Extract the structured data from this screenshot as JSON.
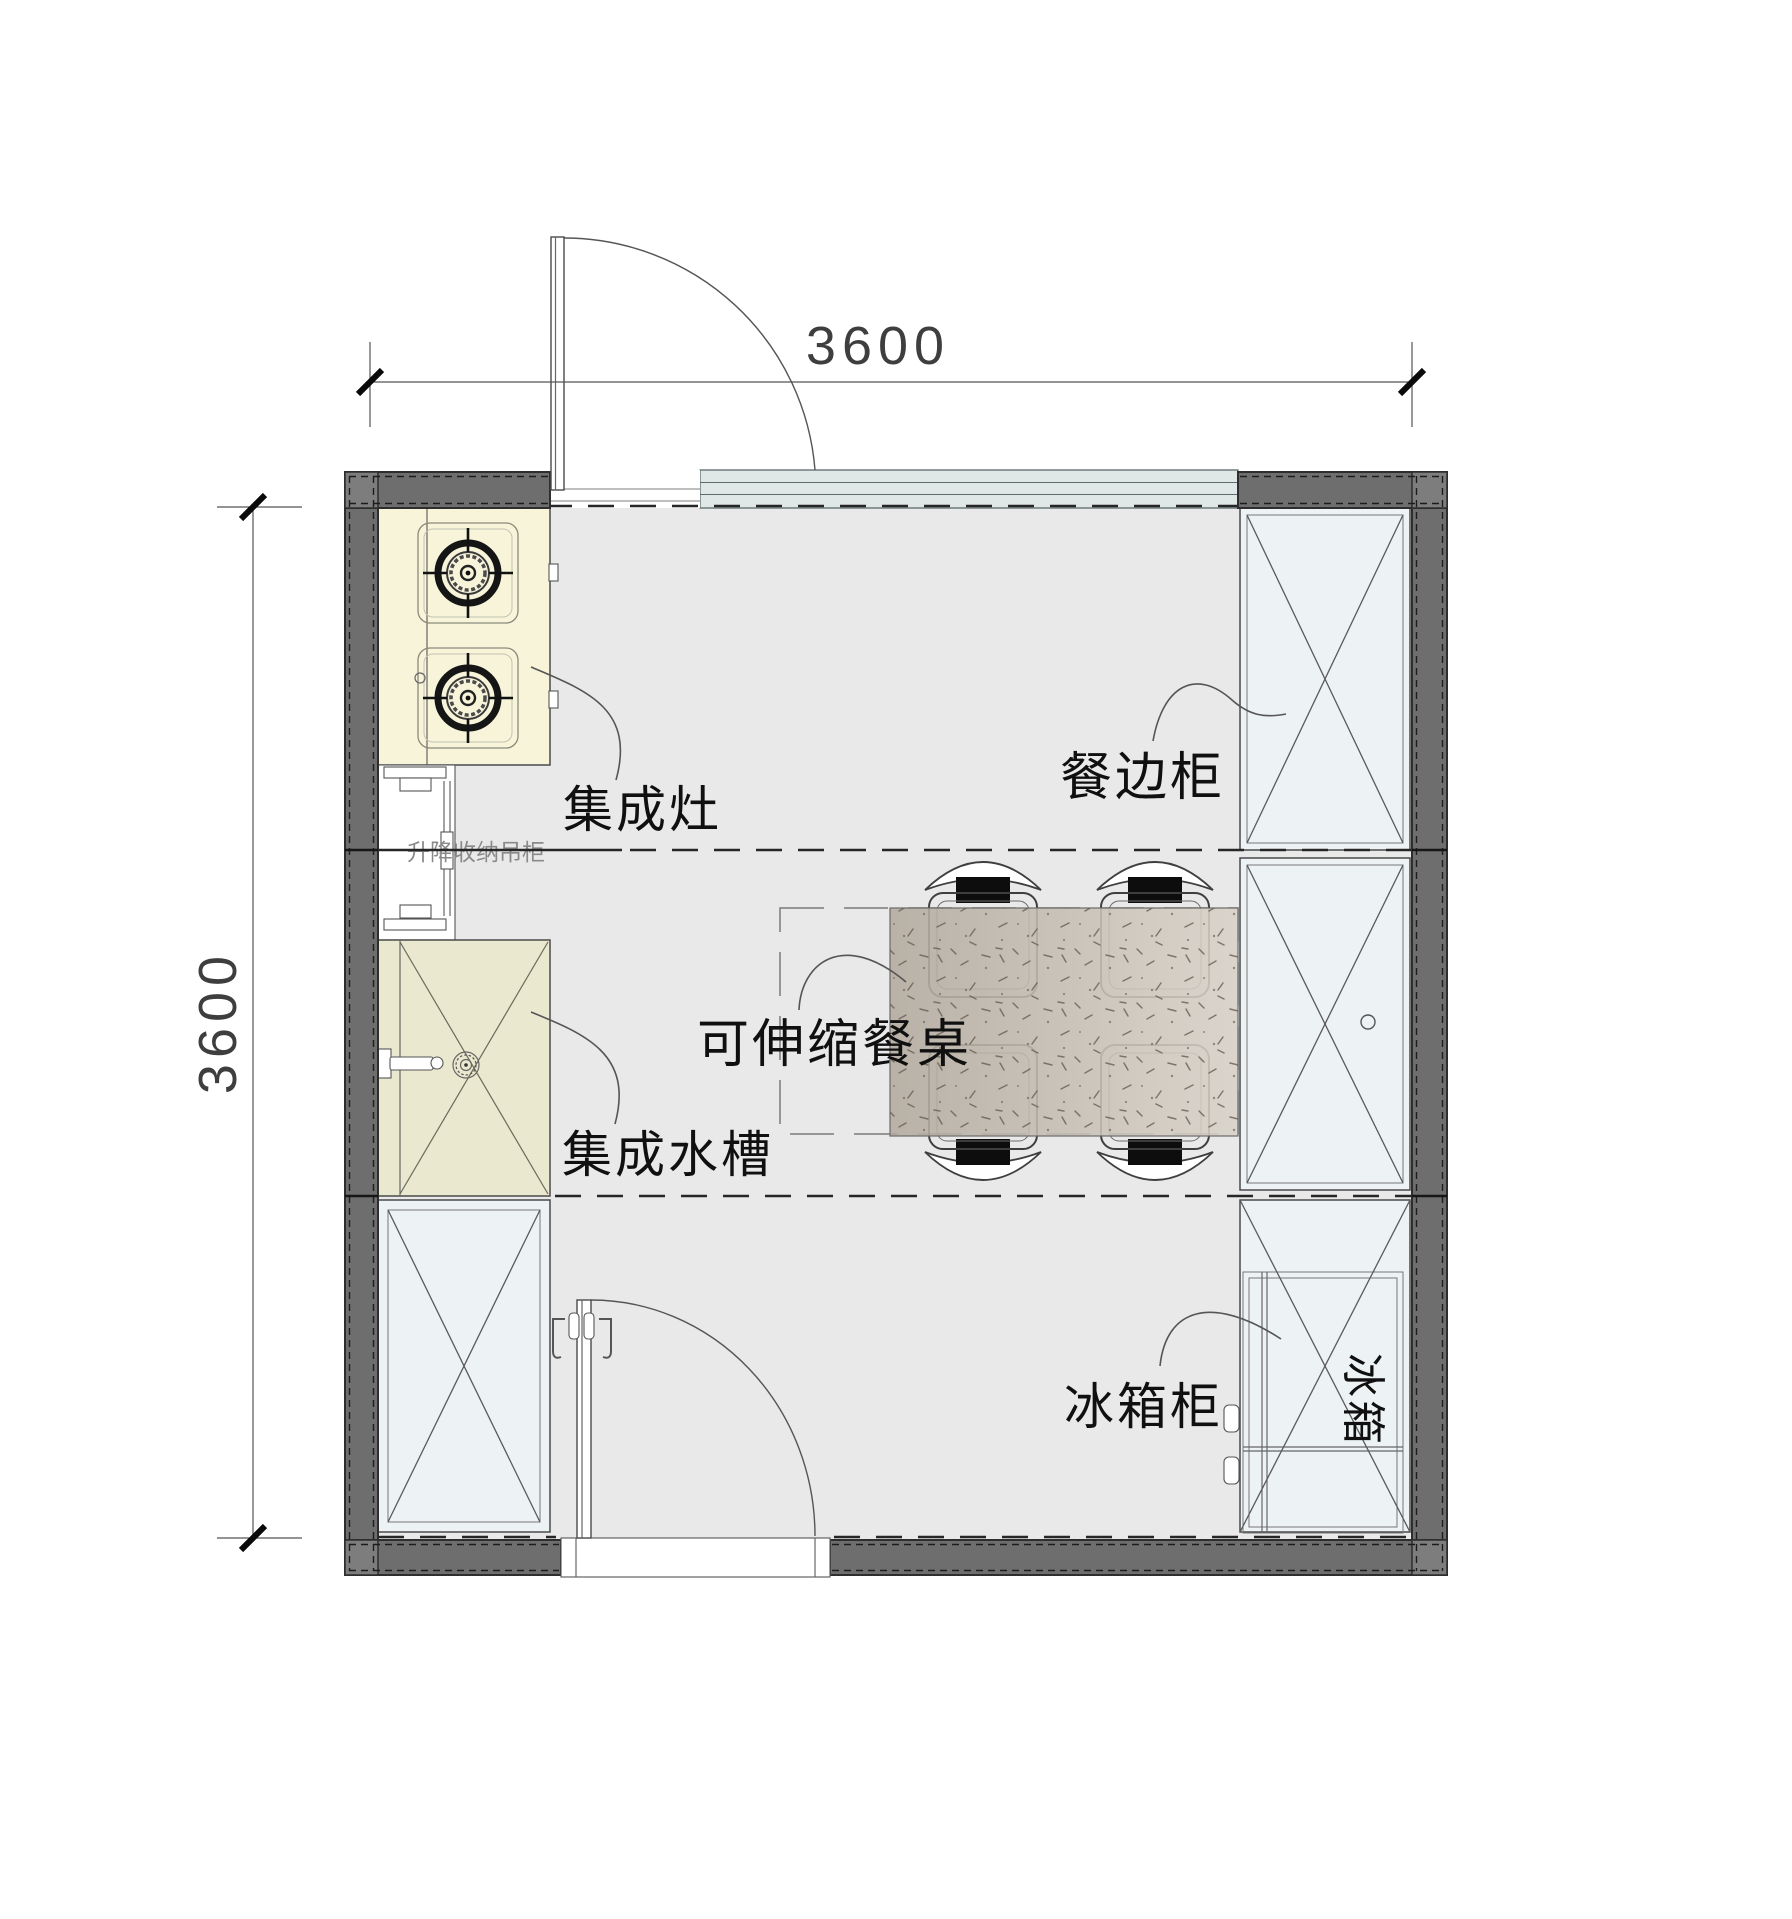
{
  "plan": {
    "dimensions": {
      "top": "3600",
      "left": "3600"
    },
    "annotations": {
      "stove": "集成灶",
      "lift_cabinet": "升降收纳吊柜",
      "sink": "集成水槽",
      "table": "可伸缩餐桌",
      "sideboard": "餐边柜",
      "fridge_cabinet": "冰箱柜",
      "fridge": "冰箱"
    },
    "colors": {
      "wall": "#6e6e6e",
      "wall_corner": "#7d7d7d",
      "floor": "#e9e9e9",
      "cabinet_fill": "#edf2f5",
      "stove_counter": "#f7f4da",
      "sink_counter": "#eae8ce",
      "window_glass": "#dfe7e7",
      "table_dark": "#b3aa9e",
      "table_light": "#d8d2c8"
    }
  }
}
